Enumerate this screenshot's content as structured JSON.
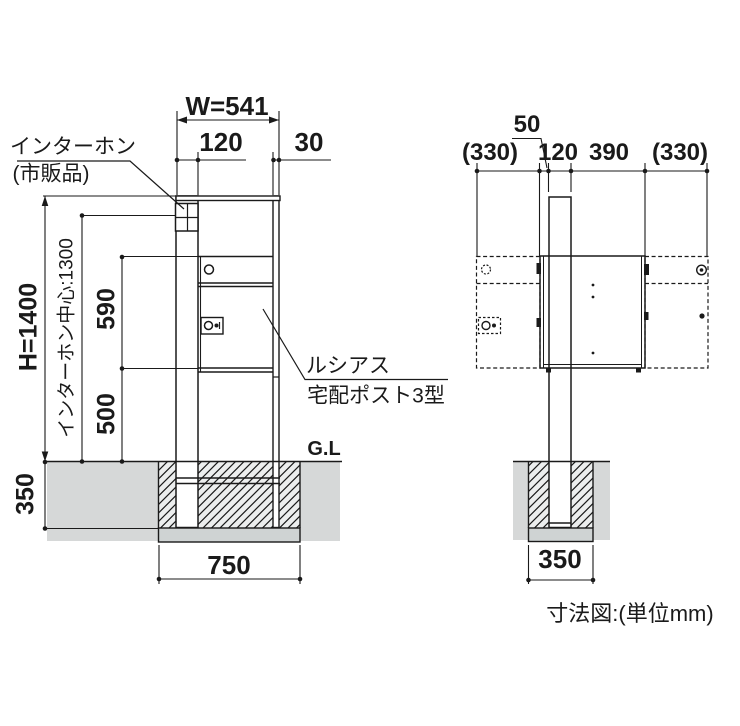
{
  "drawing": {
    "caption": "寸法図:(単位mm)",
    "front_view": {
      "labels": {
        "intercom_line1": "インターホン",
        "intercom_line2": "(市販品)",
        "product_line1": "ルシアス",
        "product_line2": "宅配ポスト3型",
        "ground_level": "G.L"
      },
      "dimensions": {
        "total_width": "W=541",
        "post_width": "120",
        "side_bar_width": "30",
        "total_height": "H=1400",
        "intercom_center_height": "インターホン中心:1300",
        "box_height": "590",
        "box_ground_clearance": "500",
        "foundation_depth": "350",
        "foundation_width": "750"
      }
    },
    "side_view": {
      "dimensions": {
        "front_offset": "50",
        "front_door_swing": "(330)",
        "post_depth": "120",
        "box_depth": "390",
        "rear_door_swing": "(330)",
        "foundation_width": "350"
      }
    },
    "colors": {
      "line": "#1a1a1a",
      "soil": "#d6d8d8",
      "hatch_fill": "#eceeee",
      "footing": "#cfd3d3"
    }
  }
}
